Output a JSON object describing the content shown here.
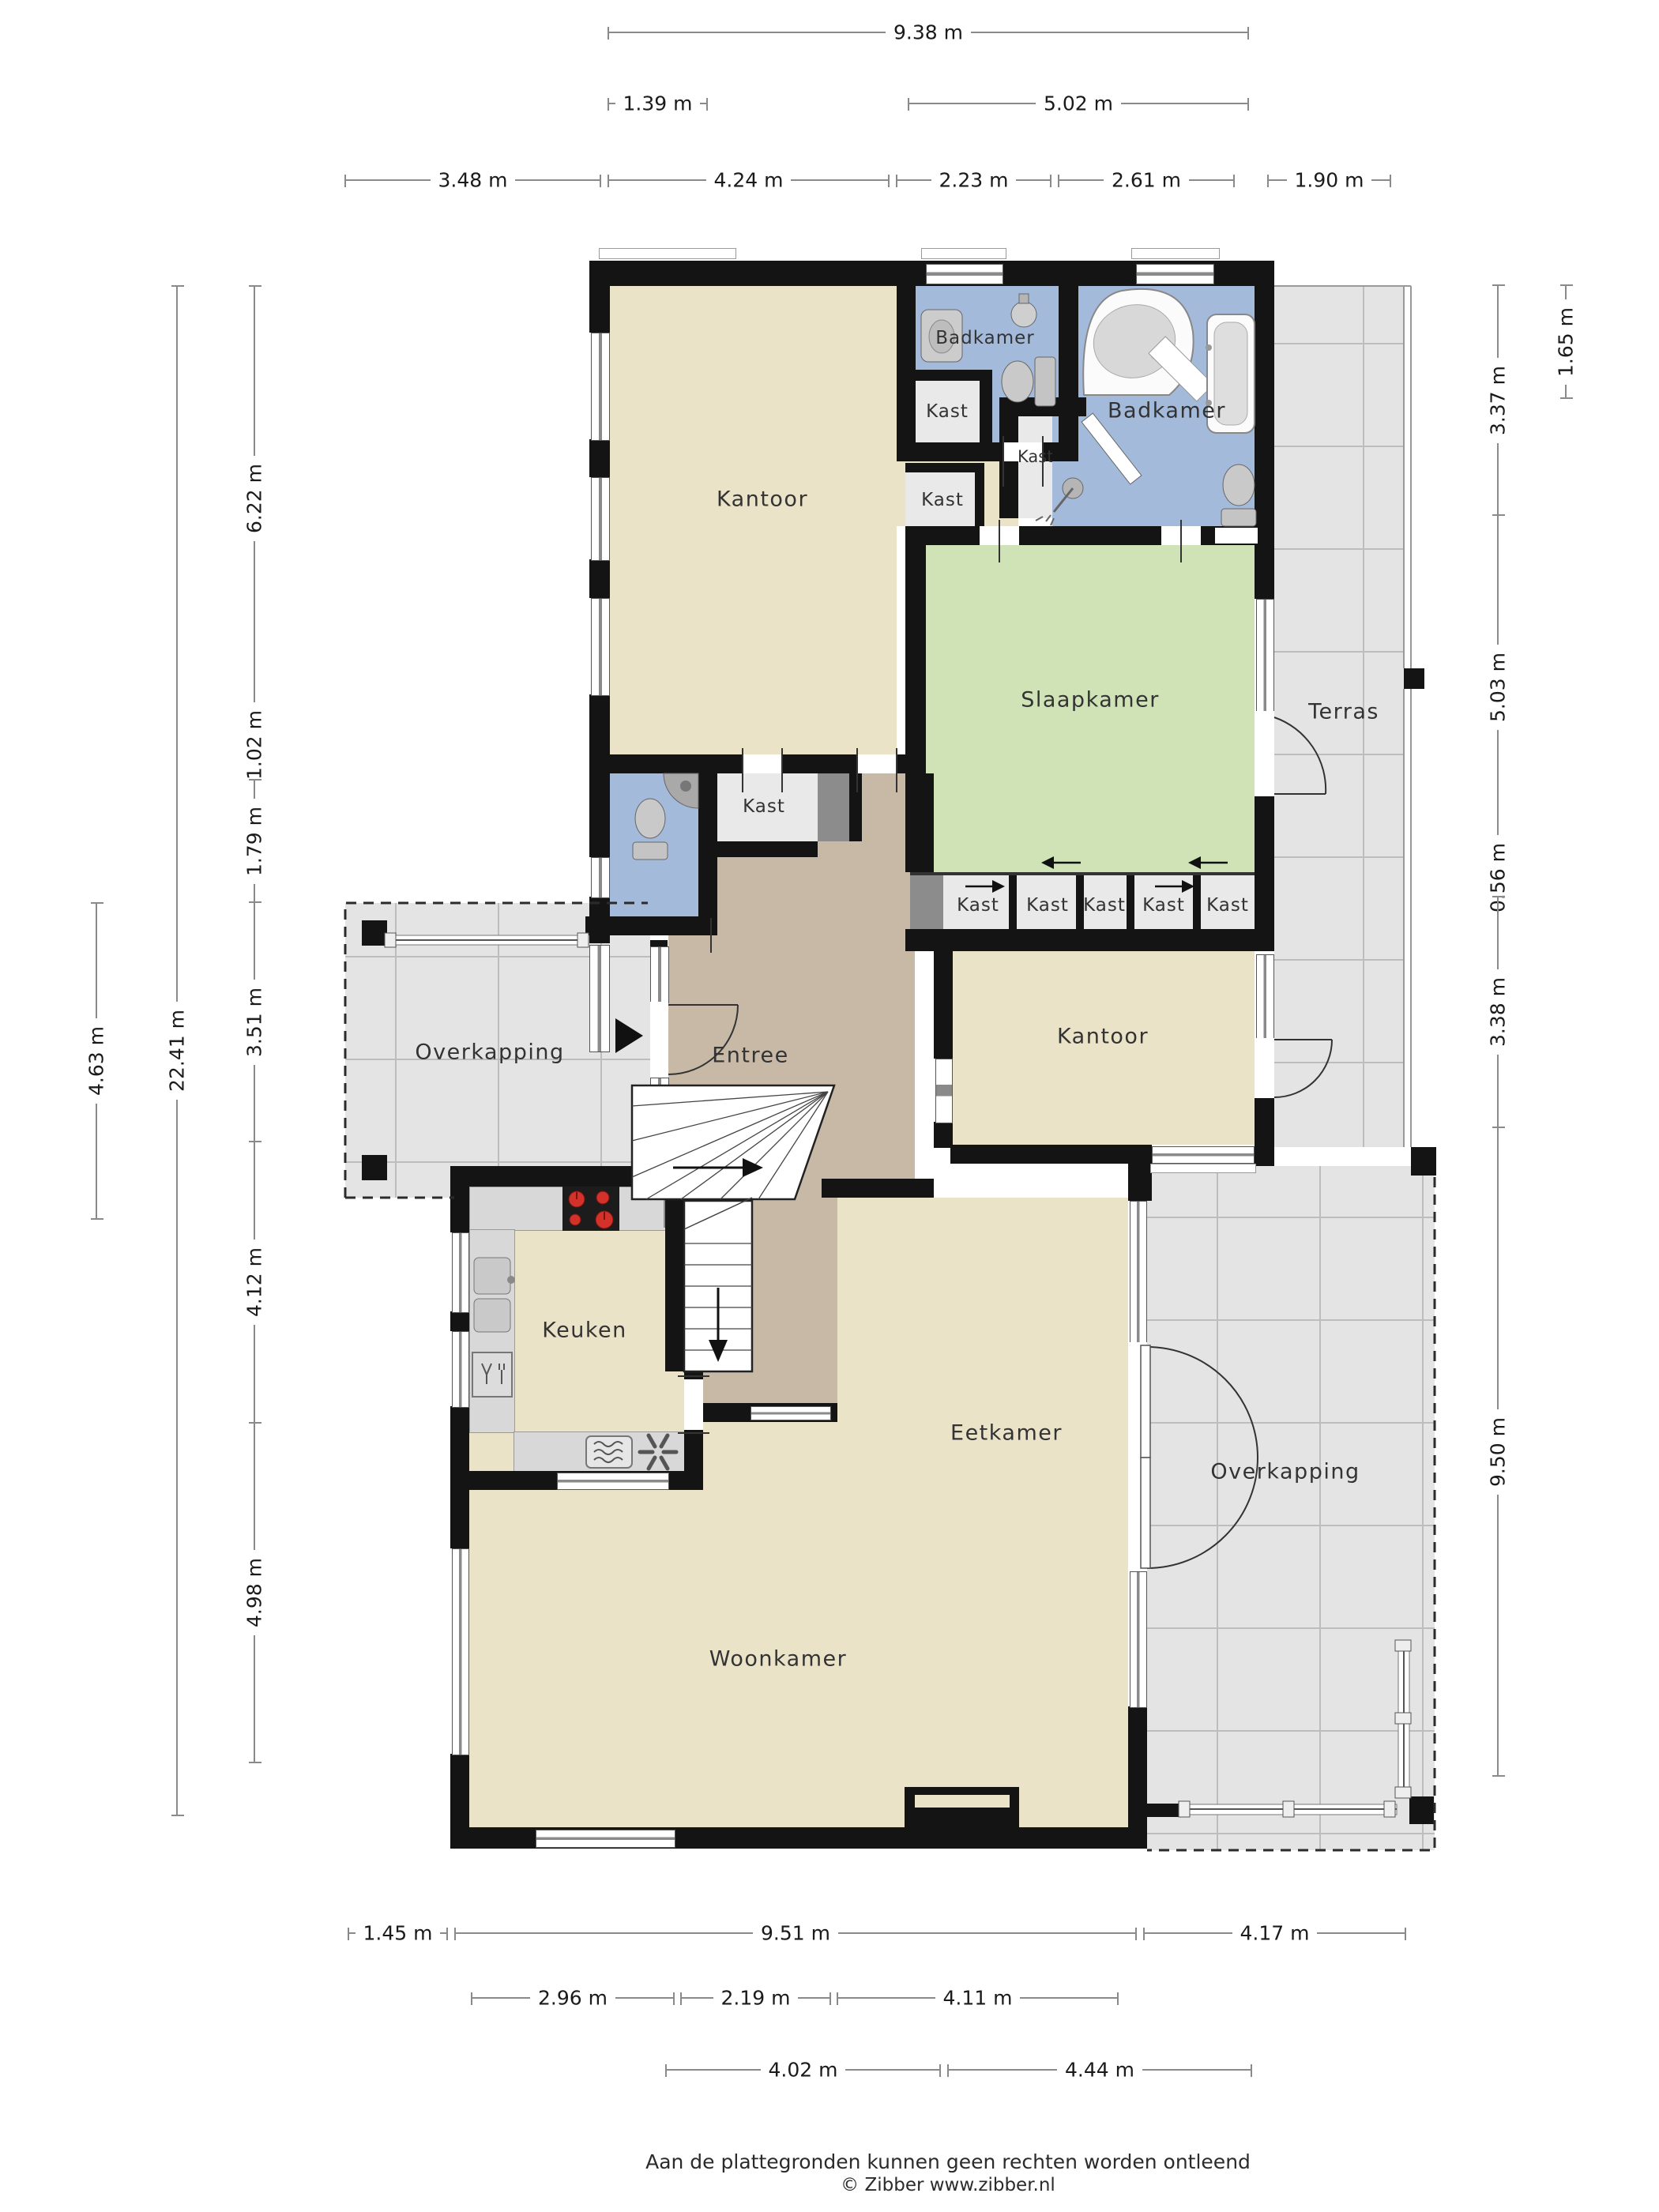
{
  "rooms": {
    "kantoor": "Kantoor",
    "badkamer": "Badkamer",
    "slaapkamer": "Slaapkamer",
    "terras": "Terras",
    "entree": "Entree",
    "overkapping": "Overkapping",
    "keuken": "Keuken",
    "eetkamer": "Eetkamer",
    "woonkamer": "Woonkamer",
    "kast": "Kast"
  },
  "dims": {
    "top": [
      "9.38 m",
      "1.39 m",
      "5.02 m"
    ],
    "top_row": [
      "3.48 m",
      "4.24 m",
      "2.23 m",
      "2.61 m",
      "1.90 m"
    ],
    "left": [
      "6.22 m",
      "1.02 m",
      "1.79 m",
      "3.51 m",
      "4.12 m",
      "4.98 m"
    ],
    "left_total": "22.41 m",
    "left_outer": "4.63 m",
    "right": [
      "3.37 m",
      "5.03 m",
      "0.56 m",
      "3.38 m",
      "9.50 m"
    ],
    "right_outer": "1.65 m",
    "bottom": [
      "1.45 m",
      "9.51 m",
      "4.17 m"
    ],
    "bottom_row2": [
      "2.96 m",
      "2.19 m",
      "4.11 m"
    ],
    "bottom_row3": [
      "4.02 m",
      "4.44 m"
    ]
  },
  "footer": {
    "disclaimer": "Aan de plattegronden kunnen geen rechten worden ontleend",
    "credit": "© Zibber www.zibber.nl"
  },
  "colors": {
    "wall": "#141414",
    "room_beige": "#EBE3C8",
    "entree_brown": "#C8B9A7",
    "bedroom_green": "#CFE3B7",
    "bath_blue": "#A4BADB",
    "tile_gray": "#E4E4E4",
    "closet_gray": "#E9E9E9",
    "counter_gray": "#D8D8D8",
    "burner_red": "#D2322A"
  }
}
